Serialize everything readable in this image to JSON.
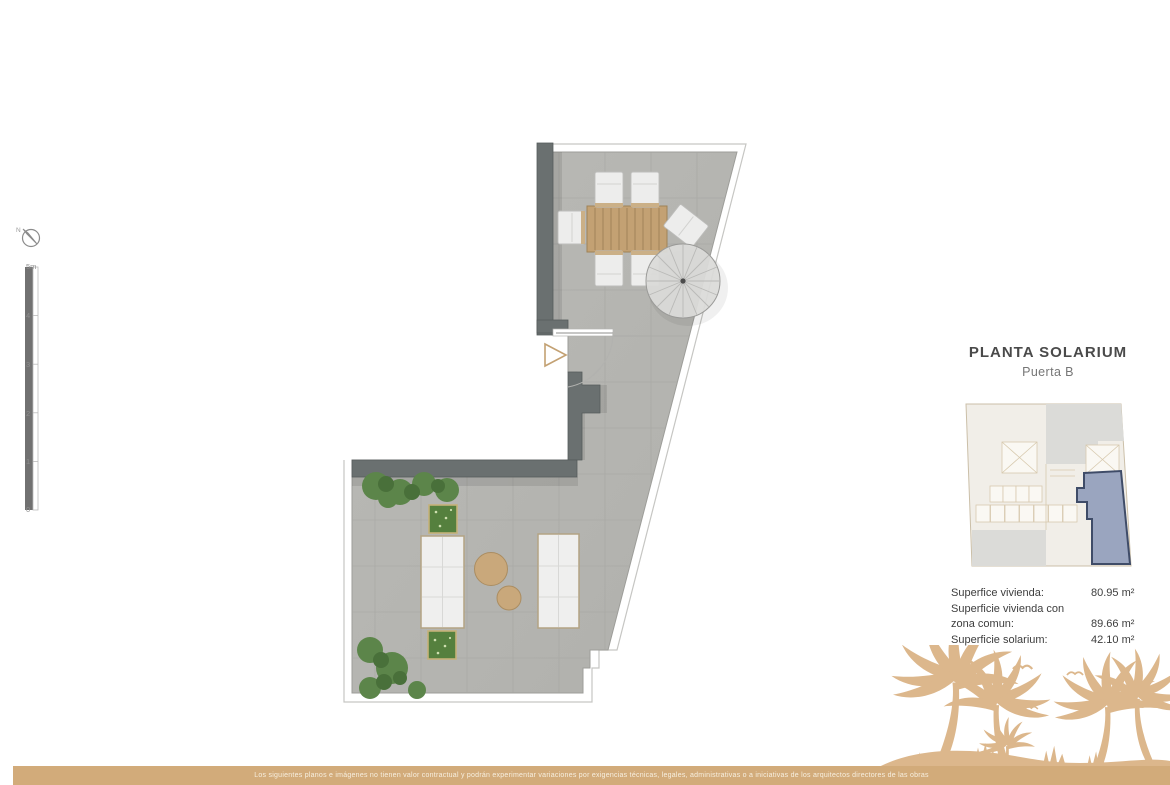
{
  "colors": {
    "accent": "#d2ab7a",
    "palm": "#dcb78c",
    "wall": "#6a7070",
    "floor": "#b6b6b2",
    "wood": "#c3a173",
    "highlight-fill": "#9aa5bf",
    "highlight-stroke": "#3f4c68",
    "text-dark": "#4a4a4a"
  },
  "compass": {
    "label": "N"
  },
  "scale_bar": {
    "labels": [
      "5m",
      "4",
      "3",
      "2",
      "1",
      "0"
    ]
  },
  "title_block": {
    "title": "PLANTA SOLARIUM",
    "subtitle": "Puerta B"
  },
  "areas": {
    "rows": [
      {
        "label": "Superfice vivienda:",
        "value": "80.95 m²"
      },
      {
        "label": "Superficie vivienda con zona comun:",
        "value": "89.66 m²"
      },
      {
        "label": "Superficie solarium:",
        "value": "42.10 m²"
      }
    ]
  },
  "footer": {
    "disclaimer": "Los siguientes planos e imágenes no tienen valor contractual y podrán experimentar variaciones por exigencias técnicas, legales, administrativas o a iniciativas de los arquitectos directores de las obras"
  }
}
